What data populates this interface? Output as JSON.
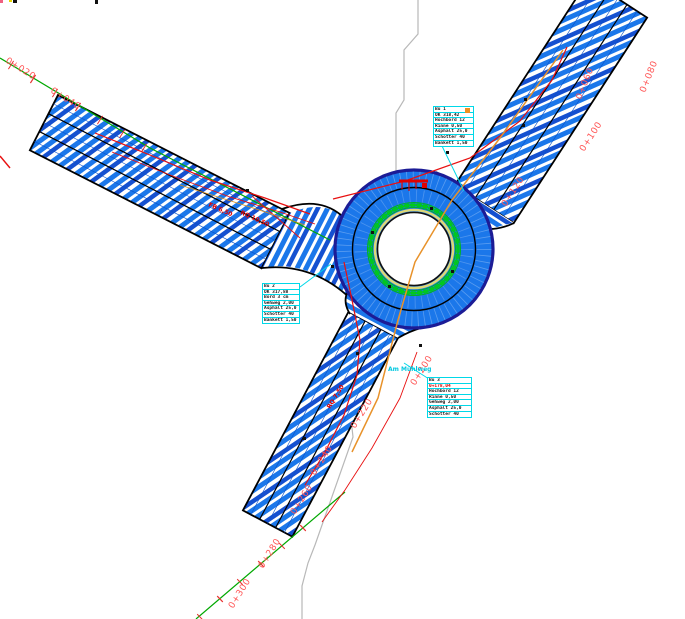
{
  "drawing": {
    "title": "roundabout-site-plan",
    "stations": {
      "northwest": [
        {
          "label": "0+020"
        },
        {
          "label": "0+040"
        }
      ],
      "northeast": [
        {
          "label": "0+120"
        },
        {
          "label": "0+100"
        },
        {
          "label": "0+060"
        },
        {
          "label": "0+080"
        }
      ],
      "south": [
        {
          "label": "0+200"
        },
        {
          "label": "0+220"
        },
        {
          "label": "0+240"
        },
        {
          "label": "0+260"
        },
        {
          "label": "0+280"
        },
        {
          "label": "0+300"
        }
      ]
    },
    "road_labels": [
      {
        "text": "FB 6,50"
      },
      {
        "text": "RQ 10,50"
      },
      {
        "text": "RQ 7,50"
      }
    ],
    "street_label": {
      "text": "Am Mühlweg"
    },
    "annotations": {
      "box_a": {
        "lines": [
          "Bü 1",
          "OK 318,42",
          "Hochbord 12",
          "Rinne 0,50",
          "Asphalt 25,0",
          "Schotter 40",
          "Bankett 1,50"
        ]
      },
      "box_b": {
        "lines": [
          "Bü 2",
          "OK 317,88",
          "Bord 3 cm",
          "Gehweg 2,00",
          "Asphalt 25,0",
          "Schotter 40",
          "Bankett 1,50"
        ]
      },
      "box_c": {
        "lines": [
          "Bü 3",
          "0+178,04",
          "Hochbord 12",
          "Rinne 0,50",
          "Gehweg 2,00",
          "Asphalt 25,0",
          "Schotter 40"
        ]
      }
    },
    "colors": {
      "road_fill_blue": "#1b77ea",
      "edge_navy": "#1c1c96",
      "axis_green": "#00a800",
      "station_red": "#ff5555",
      "annotation_cyan": "#00d8e8",
      "existing_orange": "#e8922a",
      "boundary_gray": "#b8b8b8",
      "apron_yellow": "#ddd878",
      "island_green": "#00c81e"
    }
  }
}
